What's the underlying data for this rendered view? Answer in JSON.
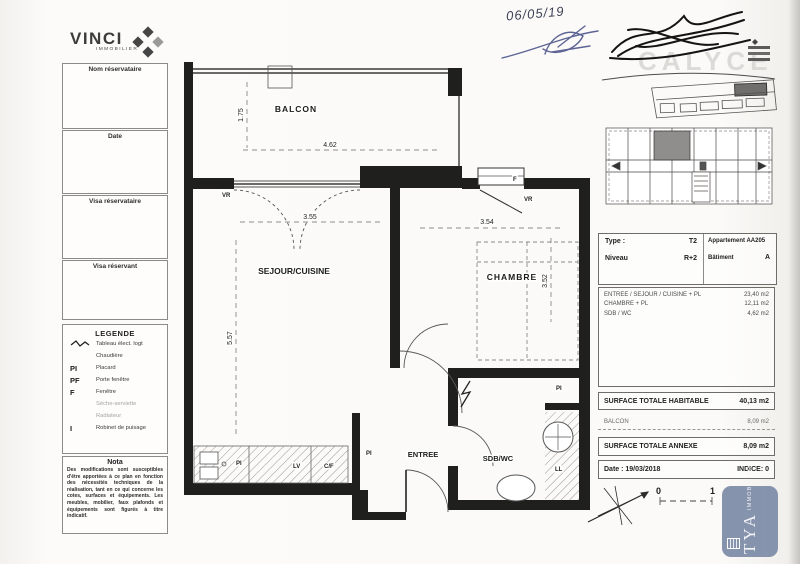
{
  "scan": {
    "handwritten_date": "06/05/19"
  },
  "logo": {
    "name": "VINCI",
    "sub": "IMMOBILIER"
  },
  "watermark": "CALYCE",
  "sidebar": {
    "boxes": [
      {
        "label": "Nom réservataire"
      },
      {
        "label": "Date"
      },
      {
        "label": "Visa réservataire"
      },
      {
        "label": "Visa réservant"
      }
    ],
    "legend": {
      "title": "LEGENDE",
      "items": [
        {
          "abbr": "",
          "label": "Tableau élect. logt"
        },
        {
          "abbr": "",
          "label": "Chaudière"
        },
        {
          "abbr": "PI",
          "label": "Placard"
        },
        {
          "abbr": "PF",
          "label": "Porte fenêtre"
        },
        {
          "abbr": "F",
          "label": "Fenêtre"
        },
        {
          "abbr": "",
          "label": "Sèche-serviette"
        },
        {
          "abbr": "",
          "label": "Radiateur"
        },
        {
          "abbr": "I",
          "label": "Robinet de puisage"
        }
      ]
    },
    "nota": {
      "title": "Nota",
      "text": "Des modifications sont susceptibles d'être apportées à ce plan en fonction des nécessités techniques de la réalisation, tant en ce qui concerne les cotes, surfaces et équipements. Les meubles, mobilier, faux plafonds et équipements sont figurés à titre indicatif."
    }
  },
  "plan": {
    "rooms": {
      "balcon": "BALCON",
      "sejour": "SEJOUR/CUISINE",
      "chambre": "CHAMBRE",
      "entree": "ENTREE",
      "sdb": "SDB/WC"
    },
    "labels": {
      "pi": "PI",
      "lv": "LV",
      "cf": "C/F",
      "ll": "LL",
      "vr": "VR",
      "f": "F"
    },
    "dims": {
      "balcon_w": "4.62",
      "balcon_d": "1.75",
      "sejour_w": "3.55",
      "sejour_d": "5.57",
      "chambre_w": "3.54",
      "chambre_d": "3.52"
    }
  },
  "info": {
    "type_label": "Type :",
    "type_value": "T2",
    "apt_label": "Appartement",
    "apt_value": "AA205",
    "niveau_label": "Niveau",
    "niveau_value": "R+2",
    "bat_label": "Bâtiment",
    "bat_value": "A",
    "rooms": [
      {
        "name": "ENTREE / SEJOUR / CUISINE + PL",
        "area": "23,40 m2"
      },
      {
        "name": "CHAMBRE + PL",
        "area": "12,11 m2"
      },
      {
        "name": "SDB / WC",
        "area": "4,62 m2"
      }
    ],
    "total_habitable_label": "SURFACE TOTALE HABITABLE",
    "total_habitable": "40,13 m2",
    "annexe_room": {
      "name": "BALCON",
      "area": "8,09 m2"
    },
    "total_annexe_label": "SURFACE TOTALE ANNEXE",
    "total_annexe": "8,09 m2",
    "date_label": "Date : 19/03/2018",
    "indice_label": "INDICE: 0"
  },
  "scale": {
    "zero": "0",
    "one": "1"
  },
  "stamp": {
    "name": "CITYA",
    "sub": "IMMOBILIER"
  }
}
